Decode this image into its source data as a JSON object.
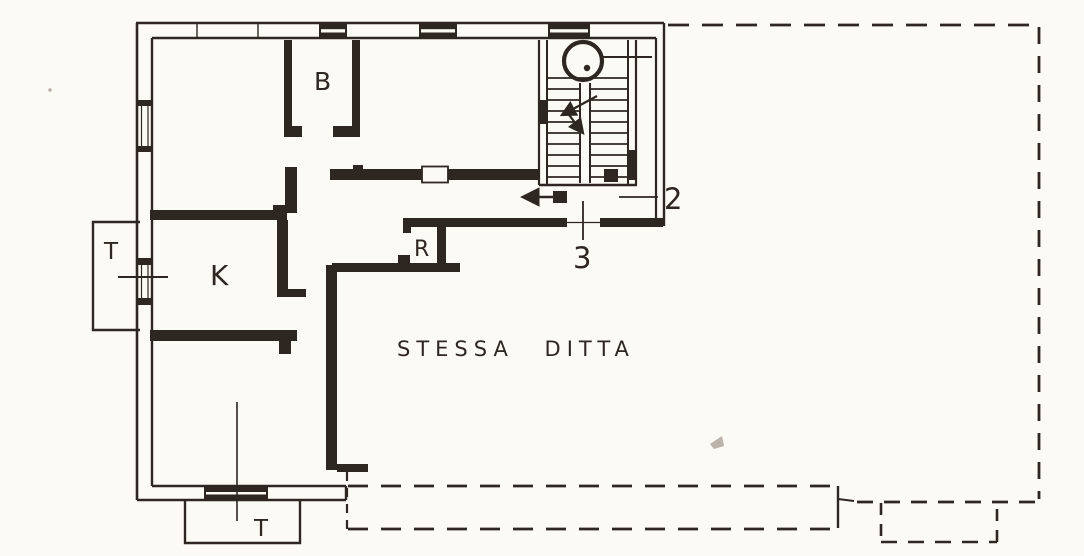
{
  "palette": {
    "paper": "#fcfaf5",
    "ink": "#2e2620"
  },
  "plan": {
    "annotation": "STESSA DITTA",
    "rooms": [
      {
        "id": "room-b",
        "label": "B"
      },
      {
        "id": "room-k",
        "label": "K"
      },
      {
        "id": "terrace-left",
        "label": "T"
      },
      {
        "id": "terrace-bottom",
        "label": "T"
      },
      {
        "id": "room-r",
        "label": "R"
      }
    ],
    "door_markers": [
      {
        "id": "marker-2",
        "label": "2"
      },
      {
        "id": "marker-3",
        "label": "3"
      }
    ],
    "symbols": {
      "corridor_arrow_direction": "left",
      "stair_arrow_direction": "down-left",
      "stair_circle": "newel-circle"
    }
  }
}
